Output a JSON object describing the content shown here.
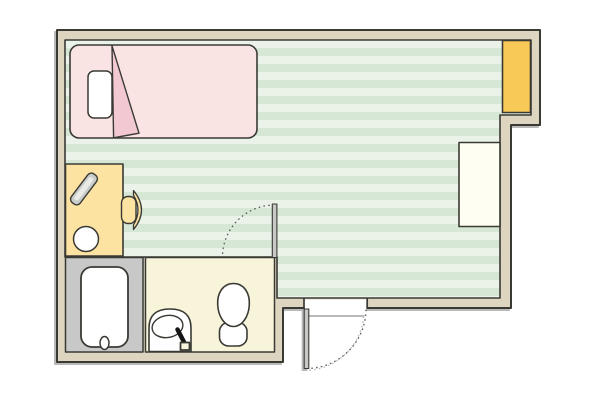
{
  "page": {
    "type": "apartment-floor-plan",
    "background": "#ffffff"
  },
  "colors": {
    "wall_fill": "#ddd5bf",
    "outline": "#3a3a35",
    "floor_stripe_light": "#ebf3e9",
    "floor_stripe_dark": "#d6e7d6",
    "bed_fill": "#f9e3e3",
    "bed_fold_fill": "#f2c9d3",
    "pillow_fill": "#ffffff",
    "desk_fill": "#fce3a2",
    "chair_fill": "#fce3a2",
    "desk_item_fill": "#c9cdc9",
    "desk_item_highlight": "#e9ebe7",
    "stool_fill": "#ffffff",
    "closet_fill": "#f9c957",
    "cabinet_fill": "#fffef2",
    "bath_floor": "#c8c8c8",
    "tub_fill": "#ffffff",
    "toilet_room_floor": "#f8f4da",
    "fixture_fill": "#ffffff",
    "door_leaf": "#c6c9c6",
    "faucet_color": "#151515",
    "opening_fill": "#ffffff"
  },
  "legend": {
    "rooms": [
      {
        "name": "main-room",
        "floor": "green-striped"
      },
      {
        "name": "bathroom",
        "floor": "gray"
      },
      {
        "name": "toilet-washroom",
        "floor": "cream"
      }
    ],
    "furniture": [
      "bed",
      "pillow",
      "folded-blanket",
      "desk",
      "desk-item-diagonal",
      "round-stool",
      "desk-chair",
      "storage-closet",
      "cabinet",
      "bathtub",
      "tub-drain",
      "washbasin",
      "faucet",
      "toilet",
      "washroom-door",
      "entrance-door"
    ]
  }
}
